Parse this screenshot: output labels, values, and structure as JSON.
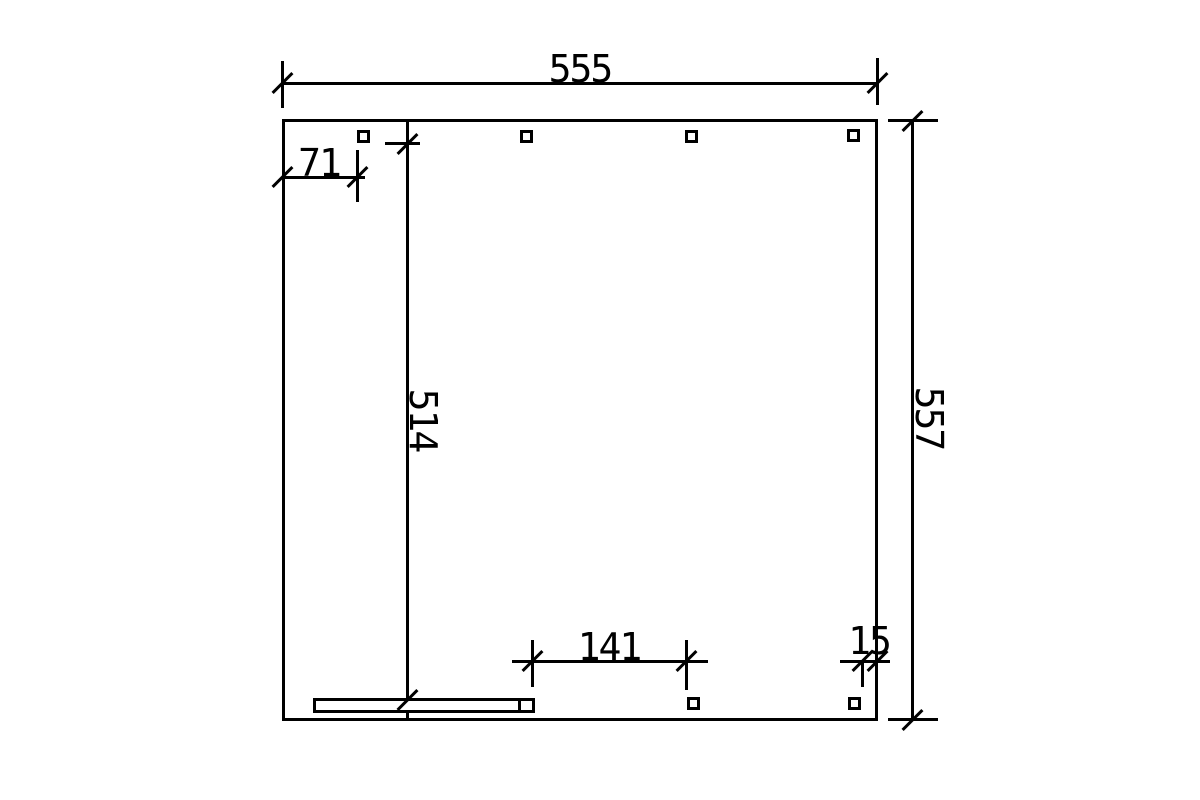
{
  "colors": {
    "background": "#ffffff",
    "ink": "#000000"
  },
  "drawing": {
    "kind": "dimensioned-plan",
    "dims": {
      "top_width": "555",
      "right_depth": "557",
      "left_offset": "71",
      "inner_depth": "514",
      "bottom_span": "141",
      "bottom_right_offset": "15"
    }
  }
}
